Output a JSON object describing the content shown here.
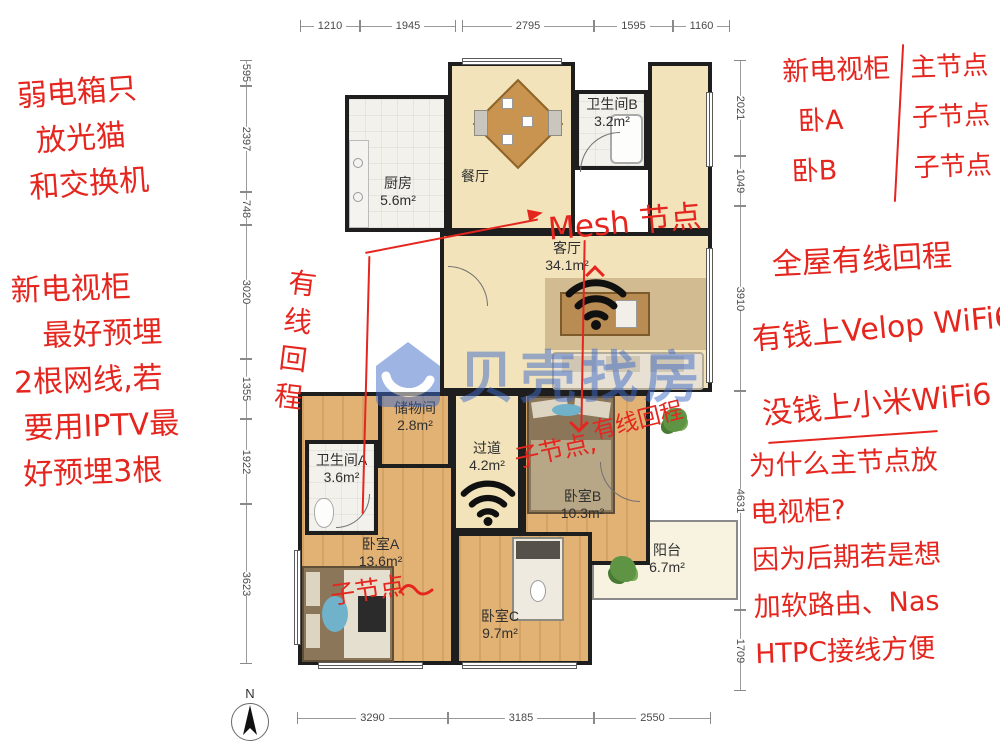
{
  "floorplan": {
    "rooms": [
      {
        "key": "kitchen",
        "name": "厨房",
        "area": "5.6m²"
      },
      {
        "key": "dining",
        "name": "餐厅",
        "area": ""
      },
      {
        "key": "bath_b",
        "name": "卫生间B",
        "area": "3.2m²"
      },
      {
        "key": "living",
        "name": "客厅",
        "area": "34.1m²"
      },
      {
        "key": "storage",
        "name": "储物间",
        "area": "2.8m²"
      },
      {
        "key": "hallway",
        "name": "过道",
        "area": "4.2m²"
      },
      {
        "key": "bath_a",
        "name": "卫生间A",
        "area": "3.6m²"
      },
      {
        "key": "bed_a",
        "name": "卧室A",
        "area": "13.6m²"
      },
      {
        "key": "bed_b",
        "name": "卧室B",
        "area": "10.3m²"
      },
      {
        "key": "bed_c",
        "name": "卧室C",
        "area": "9.7m²"
      },
      {
        "key": "balcony",
        "name": "阳台",
        "area": "6.7m²"
      }
    ],
    "dimensions": {
      "top": [
        "1210",
        "1945",
        "2795",
        "1595",
        "1160"
      ],
      "bottom": [
        "3290",
        "3185",
        "2550"
      ],
      "left": [
        "595",
        "2397",
        "748",
        "3020",
        "1355",
        "1922",
        "3623"
      ],
      "right": [
        "2021",
        "1049",
        "3910",
        "4631",
        "1709"
      ]
    },
    "compass_label": "N",
    "watermark": "贝壳找房"
  },
  "annotations": {
    "ink_color": "#e5261f",
    "left_top": [
      "弱电箱只",
      "放光猫",
      "和交换机"
    ],
    "left_mid": [
      "新电视柜",
      "最好预埋",
      "2根网线,若",
      "要用IPTV最",
      "好预埋3根"
    ],
    "backhaul_vertical": "有线回程",
    "mesh_label": "Mesh 节点",
    "bed_b_child": "子节点,",
    "bed_b_backhaul": "有线回程",
    "bed_a_child": "子节点",
    "mapping_left": [
      "新电视柜",
      "卧A",
      "卧B"
    ],
    "mapping_right": [
      "主节点",
      "子节点",
      "子节点"
    ],
    "right_mid": [
      "全屋有线回程",
      "有钱上Velop WiFi6",
      "没钱上小米WiFi6"
    ],
    "right_bottom": [
      "为什么主节点放",
      "电视柜?",
      "因为后期若是想",
      "加软路由、Nas",
      "HTPC接线方便"
    ]
  }
}
